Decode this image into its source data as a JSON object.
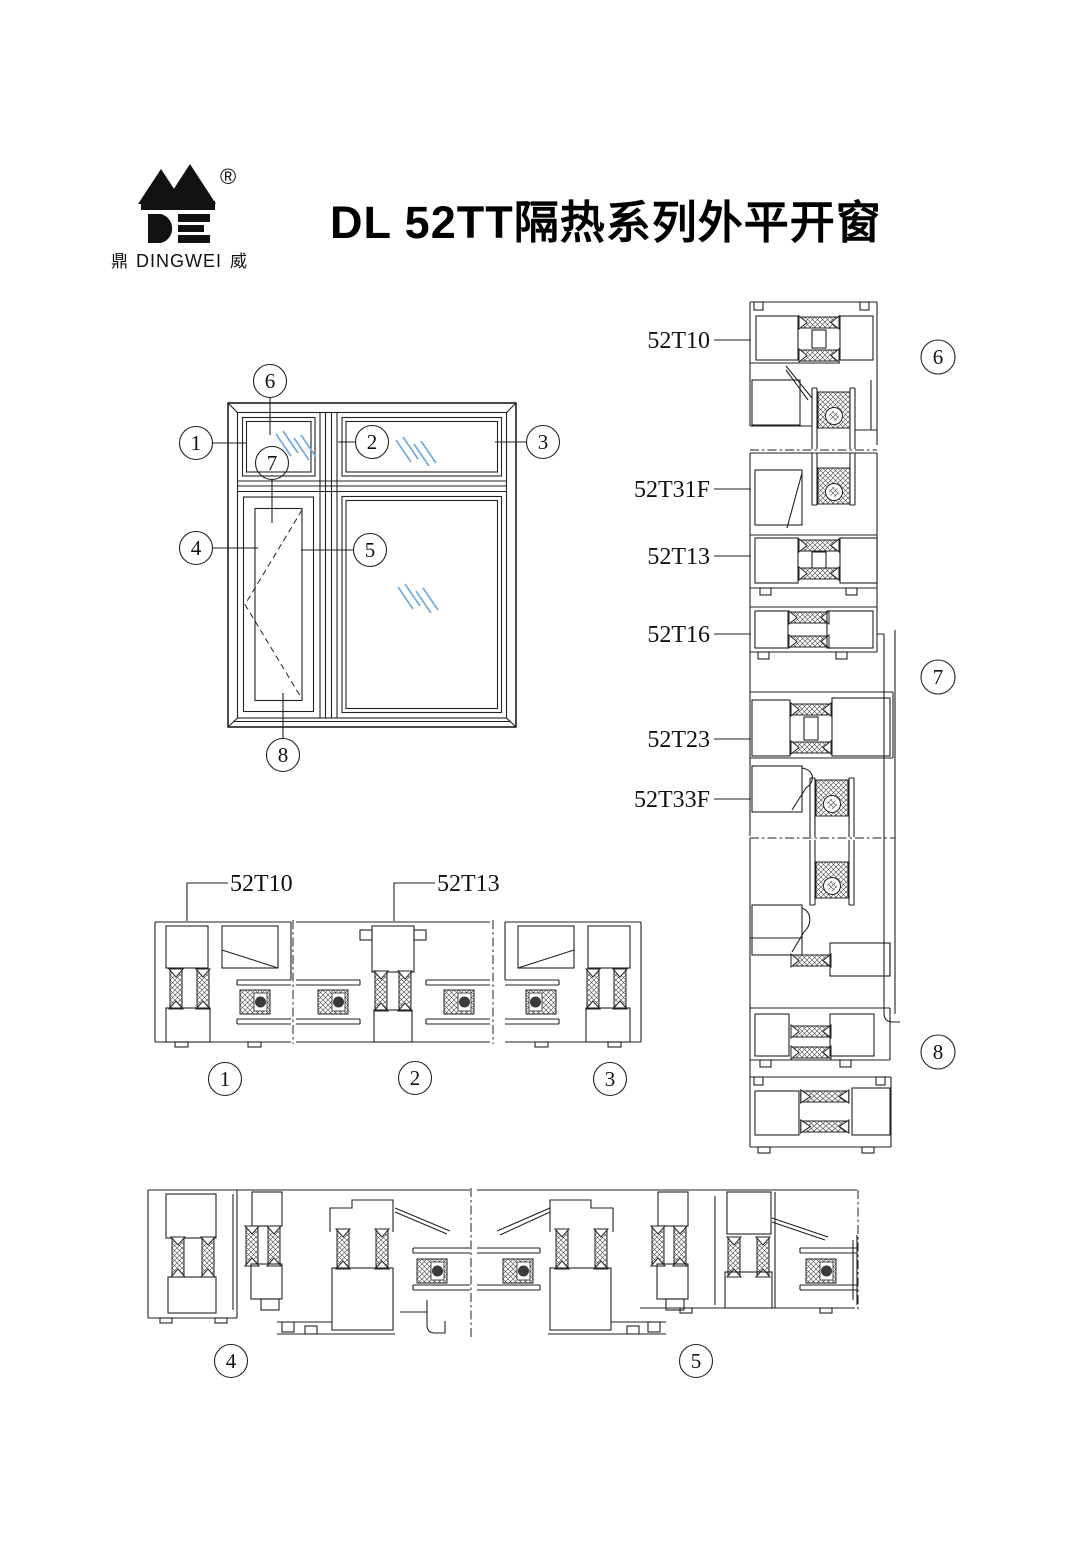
{
  "header": {
    "title": "DL 52TT隔热系列外平开窗",
    "brand": {
      "registered": "®",
      "cn_left": "鼎",
      "en": "DINGWEI",
      "cn_right": "威"
    }
  },
  "profile_labels": {
    "right_strip": [
      "52T10",
      "52T31F",
      "52T13",
      "52T16",
      "52T23",
      "52T33F"
    ],
    "plan_strip": [
      "52T10",
      "52T13"
    ]
  },
  "callouts": {
    "c1": "1",
    "c2": "2",
    "c3": "3",
    "c4": "4",
    "c5": "5",
    "c6": "6",
    "c7": "7",
    "c8": "8"
  },
  "colors": {
    "line": "#222222",
    "glass_mark": "#6FA8DC"
  }
}
